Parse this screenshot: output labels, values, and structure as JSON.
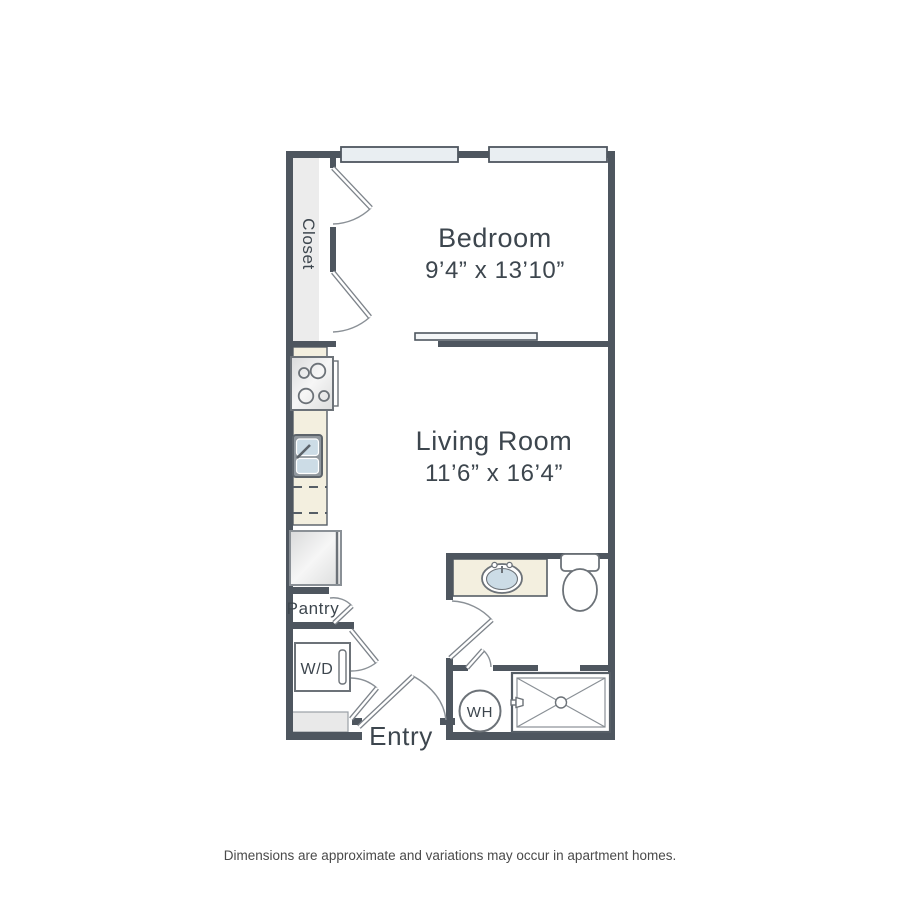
{
  "floor_plan": {
    "rooms": {
      "bedroom": {
        "name": "Bedroom",
        "dimensions": "9’4” x 13’10”"
      },
      "living_room": {
        "name": "Living Room",
        "dimensions": "11’6” x 16’4”"
      },
      "closet": {
        "name": "Closet"
      },
      "pantry": {
        "name": "Pantry"
      },
      "entry": {
        "name": "Entry"
      }
    },
    "appliances": {
      "washer_dryer": "W/D",
      "water_heater": "WH"
    },
    "colors": {
      "wall": "#4e565f",
      "counter": "#f3efdf",
      "basin": "#ccdce6",
      "closet_fill": "#ececec",
      "window_fill": "#e9eef2",
      "fixture_stroke": "#6c7278",
      "text": "#3d464e"
    }
  },
  "footer": {
    "disclaimer": "Dimensions are approximate and variations may occur in apartment homes."
  }
}
